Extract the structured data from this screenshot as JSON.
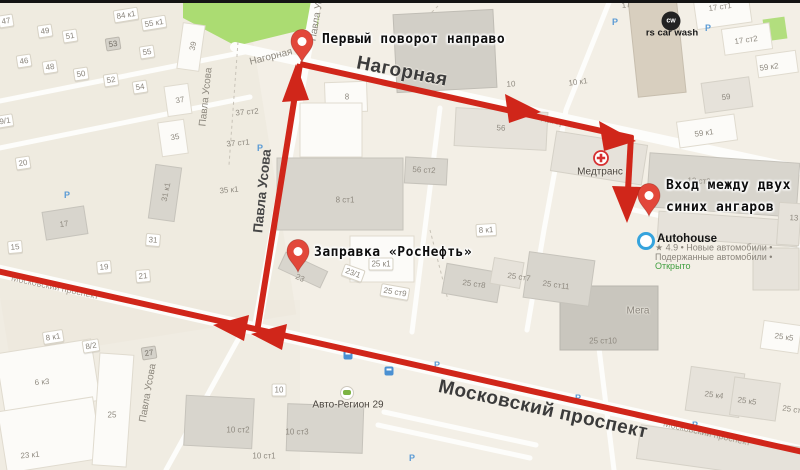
{
  "colors": {
    "route": "#d0261a",
    "pin": "#e2473a",
    "park": "#abdc72",
    "parking": "#5b9bd5",
    "transit": "#4a90d2",
    "open_status": "#3f9e3f",
    "autohouse_ring": "#35a3dd",
    "medtrans": "#d63031"
  },
  "annotations": {
    "first_turn": "Первый поворот направо",
    "entrance_line1": "Вход между двух",
    "entrance_line2": "синих ангаров",
    "gas_station": "Заправка «РосНефть»"
  },
  "pois": {
    "car_wash": {
      "icon_text": "cw",
      "label": "rs car wash"
    },
    "medtrans": {
      "label": "Медтранс"
    },
    "autohouse": {
      "label": "Autohouse",
      "info_line1": "★ 4.9 • Новые автомобили •",
      "info_line2": "Подержанные автомобили •",
      "status": "Открыто"
    },
    "auto_region": {
      "label": "Авто-Регион 29"
    },
    "mega": {
      "label": "Мега"
    }
  },
  "icons": {
    "parking_glyph": "P"
  },
  "street_labels": [
    {
      "t": "Нагорная",
      "x": 402,
      "y": 72,
      "r": 11,
      "s": "big"
    },
    {
      "t": "Московский проспект",
      "x": 543,
      "y": 410,
      "r": 12.5,
      "s": "big"
    },
    {
      "t": "Павла Усова",
      "x": 262,
      "y": 191,
      "r": -84,
      "s": "mid"
    },
    {
      "t": "Павла Усова",
      "x": 206,
      "y": 97,
      "r": -84,
      "s": "small"
    },
    {
      "t": "Павла Усова",
      "x": 148,
      "y": 393,
      "r": -80,
      "s": "small"
    },
    {
      "t": "Павла Усова",
      "x": 318,
      "y": 12,
      "r": -80,
      "s": "small"
    },
    {
      "t": "Нагорная",
      "x": 271,
      "y": 57,
      "r": -14,
      "s": "small"
    },
    {
      "t": "Нагорная",
      "x": 560,
      "y": 122,
      "r": 11,
      "s": "faint"
    },
    {
      "t": "Московский проспект",
      "x": 55,
      "y": 287,
      "r": 12,
      "s": "faint"
    },
    {
      "t": "Московский проспект",
      "x": 707,
      "y": 433,
      "r": 12.5,
      "s": "faint"
    }
  ],
  "building_labels": [
    {
      "t": "47",
      "x": 6,
      "y": 21,
      "r": -9,
      "k": "h"
    },
    {
      "t": "84 к1",
      "x": 126,
      "y": 15,
      "r": -9,
      "k": "h"
    },
    {
      "t": "55 к1",
      "x": 154,
      "y": 23,
      "r": -9,
      "k": "h"
    },
    {
      "t": "49",
      "x": 45,
      "y": 31,
      "r": -9,
      "k": "h"
    },
    {
      "t": "51",
      "x": 70,
      "y": 36,
      "r": -9,
      "k": "h"
    },
    {
      "t": "53",
      "x": 113,
      "y": 44,
      "r": -9,
      "k": "g"
    },
    {
      "t": "55",
      "x": 147,
      "y": 52,
      "r": -9,
      "k": "h"
    },
    {
      "t": "46",
      "x": 24,
      "y": 61,
      "r": -9,
      "k": "h"
    },
    {
      "t": "48",
      "x": 50,
      "y": 67,
      "r": -9,
      "k": "h"
    },
    {
      "t": "50",
      "x": 81,
      "y": 74,
      "r": -9,
      "k": "h"
    },
    {
      "t": "52",
      "x": 111,
      "y": 80,
      "r": -9,
      "k": "h"
    },
    {
      "t": "54",
      "x": 140,
      "y": 87,
      "r": -9,
      "k": "h"
    },
    {
      "t": "9/1",
      "x": 5,
      "y": 121,
      "r": -9,
      "k": "h"
    },
    {
      "t": "39",
      "x": 193,
      "y": 46,
      "r": -78,
      "k": "p"
    },
    {
      "t": "37",
      "x": 180,
      "y": 100,
      "r": -10,
      "k": "p"
    },
    {
      "t": "35",
      "x": 175,
      "y": 137,
      "r": -10,
      "k": "p"
    },
    {
      "t": "20",
      "x": 23,
      "y": 163,
      "r": -9,
      "k": "h"
    },
    {
      "t": "17",
      "x": 64,
      "y": 224,
      "r": -9,
      "k": "p"
    },
    {
      "t": "15",
      "x": 15,
      "y": 247,
      "r": -5,
      "k": "h"
    },
    {
      "t": "19",
      "x": 104,
      "y": 267,
      "r": -5,
      "k": "h"
    },
    {
      "t": "21",
      "x": 143,
      "y": 276,
      "r": -5,
      "k": "h"
    },
    {
      "t": "31 к1",
      "x": 166,
      "y": 192,
      "r": -78,
      "k": "p"
    },
    {
      "t": "31",
      "x": 153,
      "y": 240,
      "r": 5,
      "k": "h"
    },
    {
      "t": "37 ст2",
      "x": 247,
      "y": 112,
      "r": -5,
      "k": "p"
    },
    {
      "t": "37 ст1",
      "x": 238,
      "y": 143,
      "r": -5,
      "k": "p"
    },
    {
      "t": "35 к1",
      "x": 229,
      "y": 190,
      "r": -5,
      "k": "p"
    },
    {
      "t": "8",
      "x": 347,
      "y": 97,
      "r": 0,
      "k": "p"
    },
    {
      "t": "8 ст1",
      "x": 345,
      "y": 200,
      "r": 0,
      "k": "p"
    },
    {
      "t": "56",
      "x": 501,
      "y": 128,
      "r": 3,
      "k": "p"
    },
    {
      "t": "56 ст2",
      "x": 424,
      "y": 170,
      "r": 3,
      "k": "p"
    },
    {
      "t": "10",
      "x": 511,
      "y": 84,
      "r": -3,
      "k": "p"
    },
    {
      "t": "10 к1",
      "x": 578,
      "y": 82,
      "r": -8,
      "k": "p"
    },
    {
      "t": "17",
      "x": 626,
      "y": 5,
      "r": -8,
      "k": "p"
    },
    {
      "t": "17 ст1",
      "x": 720,
      "y": 7,
      "r": -8,
      "k": "p"
    },
    {
      "t": "17 ст2",
      "x": 746,
      "y": 40,
      "r": -8,
      "k": "p"
    },
    {
      "t": "59 к2",
      "x": 769,
      "y": 67,
      "r": -8,
      "k": "p"
    },
    {
      "t": "59",
      "x": 726,
      "y": 97,
      "r": -8,
      "k": "p"
    },
    {
      "t": "59 к1",
      "x": 704,
      "y": 133,
      "r": -8,
      "k": "p"
    },
    {
      "t": "13 ст2",
      "x": 699,
      "y": 181,
      "r": 3,
      "k": "p"
    },
    {
      "t": "13 с",
      "x": 797,
      "y": 218,
      "r": 3,
      "k": "p"
    },
    {
      "t": "8 к1",
      "x": 486,
      "y": 230,
      "r": -3,
      "k": "h"
    },
    {
      "t": "25 к1",
      "x": 381,
      "y": 264,
      "r": 0,
      "k": "h"
    },
    {
      "t": "23/1",
      "x": 353,
      "y": 273,
      "r": 20,
      "k": "h"
    },
    {
      "t": "23",
      "x": 300,
      "y": 278,
      "r": 25,
      "k": "p"
    },
    {
      "t": "25 ст9",
      "x": 395,
      "y": 292,
      "r": 10,
      "k": "h"
    },
    {
      "t": "25 ст8",
      "x": 474,
      "y": 284,
      "r": 8,
      "k": "p"
    },
    {
      "t": "25 ст7",
      "x": 519,
      "y": 277,
      "r": 8,
      "k": "p"
    },
    {
      "t": "25 ст11",
      "x": 556,
      "y": 285,
      "r": 8,
      "k": "p"
    },
    {
      "t": "25 ст10",
      "x": 603,
      "y": 341,
      "r": 0,
      "k": "p"
    },
    {
      "t": "25 к4",
      "x": 714,
      "y": 395,
      "r": 8,
      "k": "p"
    },
    {
      "t": "25 к5",
      "x": 747,
      "y": 401,
      "r": 8,
      "k": "p"
    },
    {
      "t": "25 к5",
      "x": 784,
      "y": 337,
      "r": 8,
      "k": "p"
    },
    {
      "t": "25 ст12",
      "x": 796,
      "y": 410,
      "r": 8,
      "k": "p"
    },
    {
      "t": "8 к1",
      "x": 53,
      "y": 337,
      "r": -9,
      "k": "h"
    },
    {
      "t": "8/2",
      "x": 91,
      "y": 346,
      "r": -9,
      "k": "h"
    },
    {
      "t": "27",
      "x": 149,
      "y": 353,
      "r": -9,
      "k": "g"
    },
    {
      "t": "6 к3",
      "x": 42,
      "y": 382,
      "r": -5,
      "k": "p"
    },
    {
      "t": "23 к1",
      "x": 30,
      "y": 455,
      "r": -5,
      "k": "p"
    },
    {
      "t": "25",
      "x": 112,
      "y": 415,
      "r": 0,
      "k": "p"
    },
    {
      "t": "10",
      "x": 279,
      "y": 390,
      "r": 0,
      "k": "h"
    },
    {
      "t": "10 ст2",
      "x": 238,
      "y": 430,
      "r": 0,
      "k": "p"
    },
    {
      "t": "10 ст1",
      "x": 264,
      "y": 456,
      "r": 0,
      "k": "p"
    },
    {
      "t": "10 ст3",
      "x": 297,
      "y": 432,
      "r": 0,
      "k": "p"
    }
  ],
  "parking_icons": [
    {
      "x": 615,
      "y": 22
    },
    {
      "x": 708,
      "y": 28
    },
    {
      "x": 67,
      "y": 195
    },
    {
      "x": 260,
      "y": 148
    },
    {
      "x": 437,
      "y": 365
    },
    {
      "x": 578,
      "y": 398
    },
    {
      "x": 695,
      "y": 425
    },
    {
      "x": 412,
      "y": 458
    }
  ],
  "transit_stops": [
    {
      "x": 348,
      "y": 355
    },
    {
      "x": 389,
      "y": 371
    }
  ]
}
